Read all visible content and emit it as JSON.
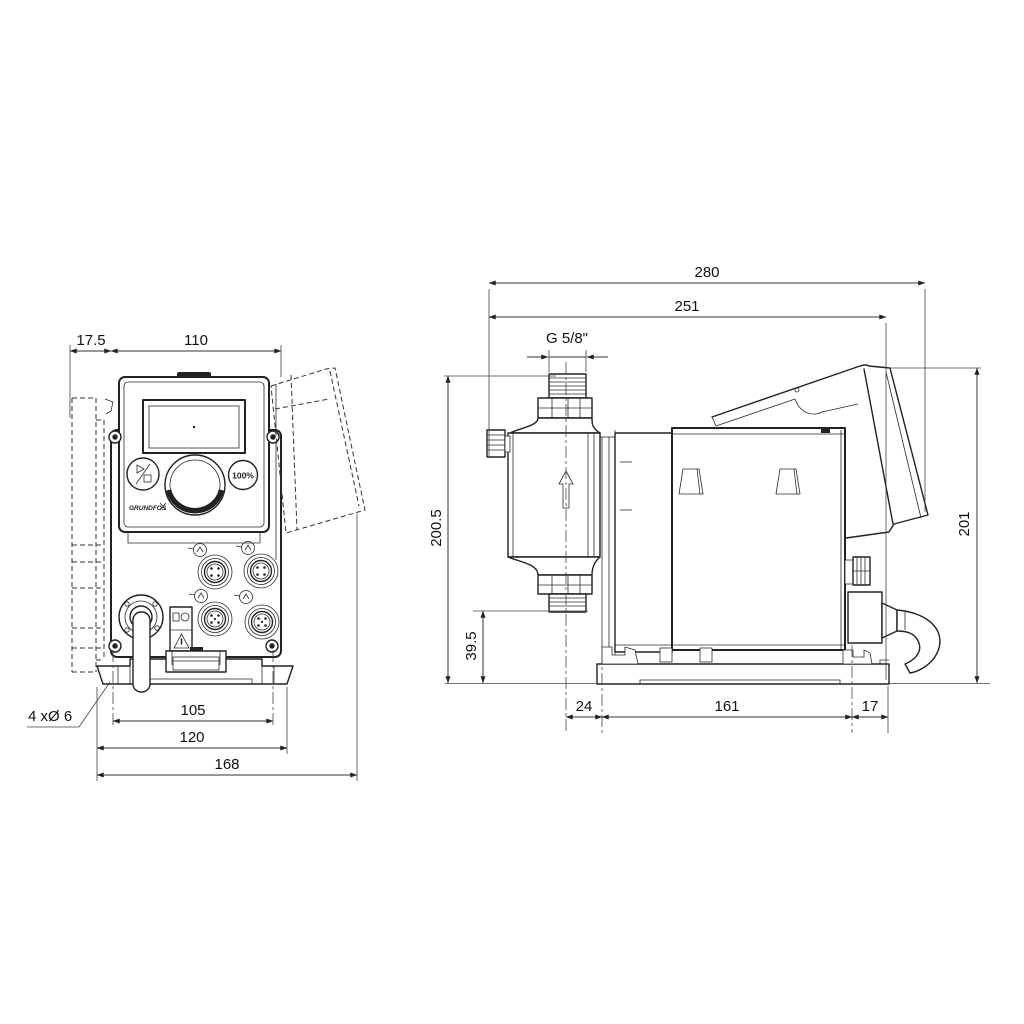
{
  "drawing": {
    "type": "dimensional-drawing",
    "front_view": {
      "dims": {
        "bracket_offset": "17.5",
        "body_width": "110",
        "mounting_hole_span": "105",
        "base_hole_span": "120",
        "overall_width": "168",
        "mounting_holes_note": "4 xØ 6"
      },
      "panel": {
        "priming_button_label": "100%",
        "logo_text": "GRUNDFOS"
      }
    },
    "side_view": {
      "dims": {
        "overall_depth": "280",
        "depth_to_cover": "251",
        "connection_thread": "G 5/8\"",
        "height_above_base": "200.5",
        "connection_clearance": "39.5",
        "overall_height": "201",
        "center_to_front_hole": "24",
        "foot_hole_span": "161",
        "rear_hole_to_edge": "17"
      }
    }
  }
}
